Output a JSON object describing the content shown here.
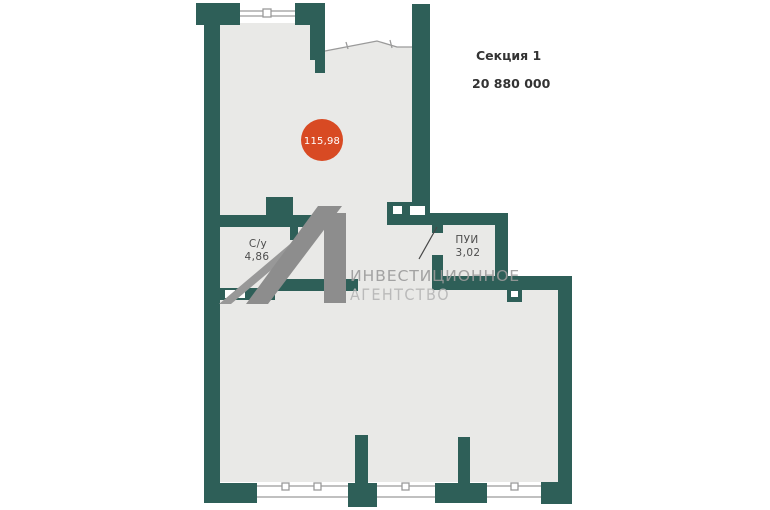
{
  "header": {
    "section_label": "Секция 1",
    "price": "20 880 000"
  },
  "plan": {
    "area_badge": {
      "value": "115,98"
    },
    "rooms": [
      {
        "name": "С/у",
        "area": "4,86"
      },
      {
        "name": "ПУИ",
        "area": "3,02"
      }
    ],
    "watermark": {
      "line1": "ИНВЕСТИЦИОННОЕ",
      "line2": "АГЕНТСТВО"
    }
  },
  "colors": {
    "background": "#ffffff",
    "wall": "#2e5f58",
    "floor": "#e9e9e7",
    "window_line": "#9a9a9a",
    "door_line": "#474747",
    "badge": "#d84a23",
    "badge_text": "#ffffff",
    "label": "#4d4d4d",
    "header_text": "#333333",
    "watermark_logo": "#8d8d8d",
    "watermark_logo_light": "#989898",
    "watermark_text1": "#9b9b9b",
    "watermark_text2": "#b6b6b6"
  }
}
